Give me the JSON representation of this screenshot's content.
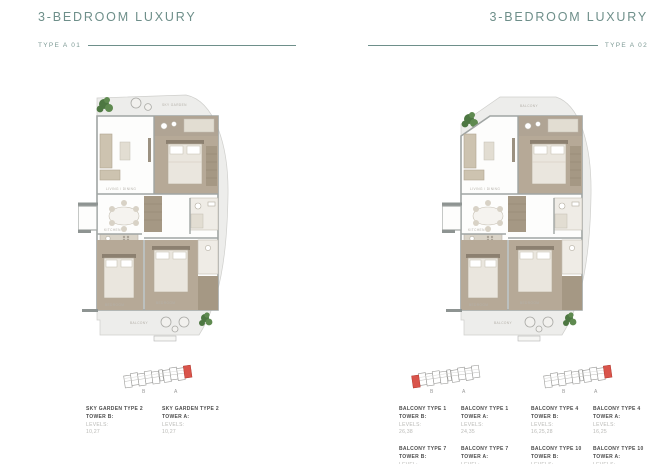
{
  "colors": {
    "accent_teal": "#6e8f8a",
    "keyplan_highlight_red": "#d9544b",
    "taupe_floor": "#b6a997",
    "annotation_dark": "#4c4c4c",
    "annotation_light": "#b8b8b5"
  },
  "left": {
    "title": "3-BEDROOM LUXURY",
    "type_label": "TYPE A 01",
    "units": [
      {
        "name": "SKY GARDEN TYPE 2",
        "tower": "TOWER B:",
        "levels_label": "LEVELS:",
        "levels": "10,27"
      },
      {
        "name": "SKY GARDEN TYPE 2",
        "tower": "TOWER A:",
        "levels_label": "LEVELS:",
        "levels": "10,27"
      }
    ]
  },
  "right": {
    "title": "3-BEDROOM LUXURY",
    "type_label": "TYPE A 02",
    "groups": [
      {
        "units": [
          {
            "name": "BALCONY TYPE 1",
            "tower": "TOWER B:",
            "levels_label": "LEVELS:",
            "levels": "26,38"
          },
          {
            "name": "BALCONY TYPE 1",
            "tower": "TOWER A:",
            "levels_label": "LEVELS:",
            "levels": "24,35"
          },
          {
            "name": "BALCONY TYPE 7",
            "tower": "TOWER B:",
            "levels_label": "LEVEL:",
            "levels": "9"
          },
          {
            "name": "BALCONY TYPE 7",
            "tower": "TOWER A:",
            "levels_label": "LEVEL:",
            "levels": "11,38"
          }
        ]
      },
      {
        "units": [
          {
            "name": "BALCONY TYPE 4",
            "tower": "TOWER B:",
            "levels_label": "LEVELS:",
            "levels": "16,25,28"
          },
          {
            "name": "BALCONY TYPE 4",
            "tower": "TOWER A:",
            "levels_label": "LEVELS:",
            "levels": "16,25"
          },
          {
            "name": "BALCONY TYPE 10",
            "tower": "TOWER B:",
            "levels_label": "LEVELS:",
            "levels": "5,7"
          },
          {
            "name": "BALCONY TYPE 10",
            "tower": "TOWER A:",
            "levels_label": "LEVELS:",
            "levels": "5,7"
          }
        ]
      }
    ]
  },
  "keyplan": {
    "letters": [
      "B",
      "A"
    ]
  },
  "plan_labels": {
    "sky_garden": "SKY GARDEN",
    "balcony_top": "BALCONY",
    "living": "LIVING / DINING",
    "kitchen": "KITCHEN",
    "bedroom": "BEDROOM",
    "balcony": "BALCONY"
  }
}
